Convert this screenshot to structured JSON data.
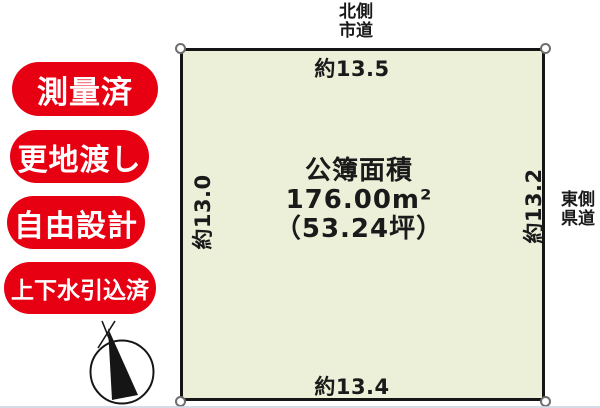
{
  "colors": {
    "badge_red": "#e60012",
    "plot_fill": "#edf0d9",
    "line_black": "#151515"
  },
  "badges": [
    {
      "label": "測量済"
    },
    {
      "label": "更地渡し"
    },
    {
      "label": "自由設計"
    },
    {
      "label": "上下水引込済"
    }
  ],
  "roads": {
    "north": {
      "line1": "北側",
      "line2": "市道"
    },
    "east": {
      "line1": "東側",
      "line2": "県道"
    }
  },
  "dimensions": {
    "top": "約13.5",
    "left": "約13.0",
    "right": "約13.2",
    "bottom": "約13.4"
  },
  "area": {
    "title": "公簿面積",
    "square_meters": "176.00m²",
    "tsubo": "（53.24坪）"
  },
  "icons": {
    "compass": "north-compass-icon",
    "corner_marker": "boundary-point-icon"
  }
}
